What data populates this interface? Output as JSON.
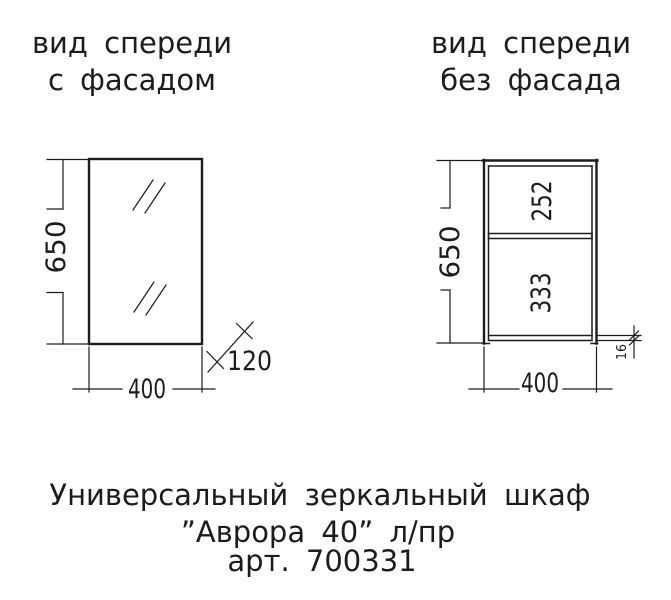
{
  "page": {
    "background": "#ffffff",
    "line_color": "#1c1c1c"
  },
  "views": {
    "with_facade": {
      "title_line1": "вид спереди",
      "title_line2": "с фасадом",
      "dim_height": "650",
      "dim_width": "400",
      "dim_depth": "120"
    },
    "without_facade": {
      "title_line1": "вид спереди",
      "title_line2": "без фасада",
      "dim_height": "650",
      "dim_width": "400",
      "dim_upper_section": "252",
      "dim_lower_section": "333",
      "dim_bottom_panel": "16"
    }
  },
  "caption": {
    "line1": "Универсальный зеркальный шкаф",
    "line2": "”Аврора 40” л/пр",
    "line3": "арт. 700331"
  }
}
